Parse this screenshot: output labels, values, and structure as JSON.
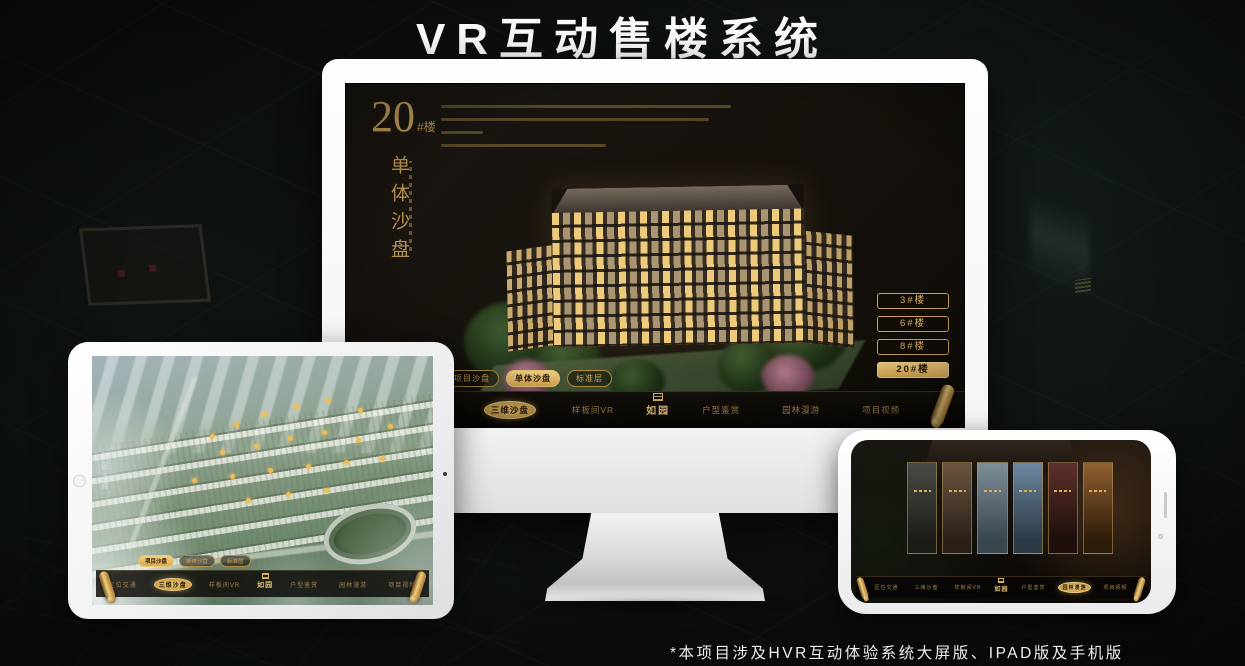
{
  "page": {
    "title": "VR互动售楼系统",
    "footnote": "*本项目涉及HVR互动体验系统大屏版、IPAD版及手机版"
  },
  "brand": {
    "logo_text": "如园",
    "gold": "#c9a257",
    "gold_bright": "#f0cd7e"
  },
  "monitor": {
    "headline": {
      "number": "20",
      "suffix": "#楼",
      "subtitle": "单体沙盘"
    },
    "sub_tabs": [
      {
        "label": "项目沙盘",
        "active": false
      },
      {
        "label": "单体沙盘",
        "active": true
      },
      {
        "label": "标准层",
        "active": false
      }
    ],
    "floor_buttons": [
      {
        "label": "3#楼",
        "active": false
      },
      {
        "label": "6#楼",
        "active": false
      },
      {
        "label": "8#楼",
        "active": false
      },
      {
        "label": "20#楼",
        "active": true
      }
    ],
    "nav_left": [
      {
        "label": "区位交通",
        "active": false
      },
      {
        "label": "三维沙盘",
        "active": true
      },
      {
        "label": "样板间VR",
        "active": false
      }
    ],
    "nav_right": [
      {
        "label": "户型鉴赏",
        "active": false
      },
      {
        "label": "园林漫游",
        "active": false
      },
      {
        "label": "项目视频",
        "active": false
      }
    ]
  },
  "tablet": {
    "road_label": "园区三路",
    "sub_tabs": [
      {
        "label": "项目沙盘",
        "active": true
      },
      {
        "label": "单体沙盘",
        "active": false
      },
      {
        "label": "标准层",
        "active": false
      }
    ],
    "nav_left": [
      {
        "label": "区位交通",
        "active": false
      },
      {
        "label": "三维沙盘",
        "active": true
      },
      {
        "label": "样板间VR",
        "active": false
      }
    ],
    "nav_right": [
      {
        "label": "户型鉴赏",
        "active": false
      },
      {
        "label": "园林漫游",
        "active": false
      },
      {
        "label": "项目视频",
        "active": false
      }
    ]
  },
  "phone": {
    "nav_left": [
      {
        "label": "区位交通",
        "active": false
      },
      {
        "label": "三维沙盘",
        "active": false
      },
      {
        "label": "样板间VR",
        "active": false
      }
    ],
    "nav_right": [
      {
        "label": "户型鉴赏",
        "active": false
      },
      {
        "label": "园林漫游",
        "active": true
      },
      {
        "label": "项目视频",
        "active": false
      }
    ]
  }
}
